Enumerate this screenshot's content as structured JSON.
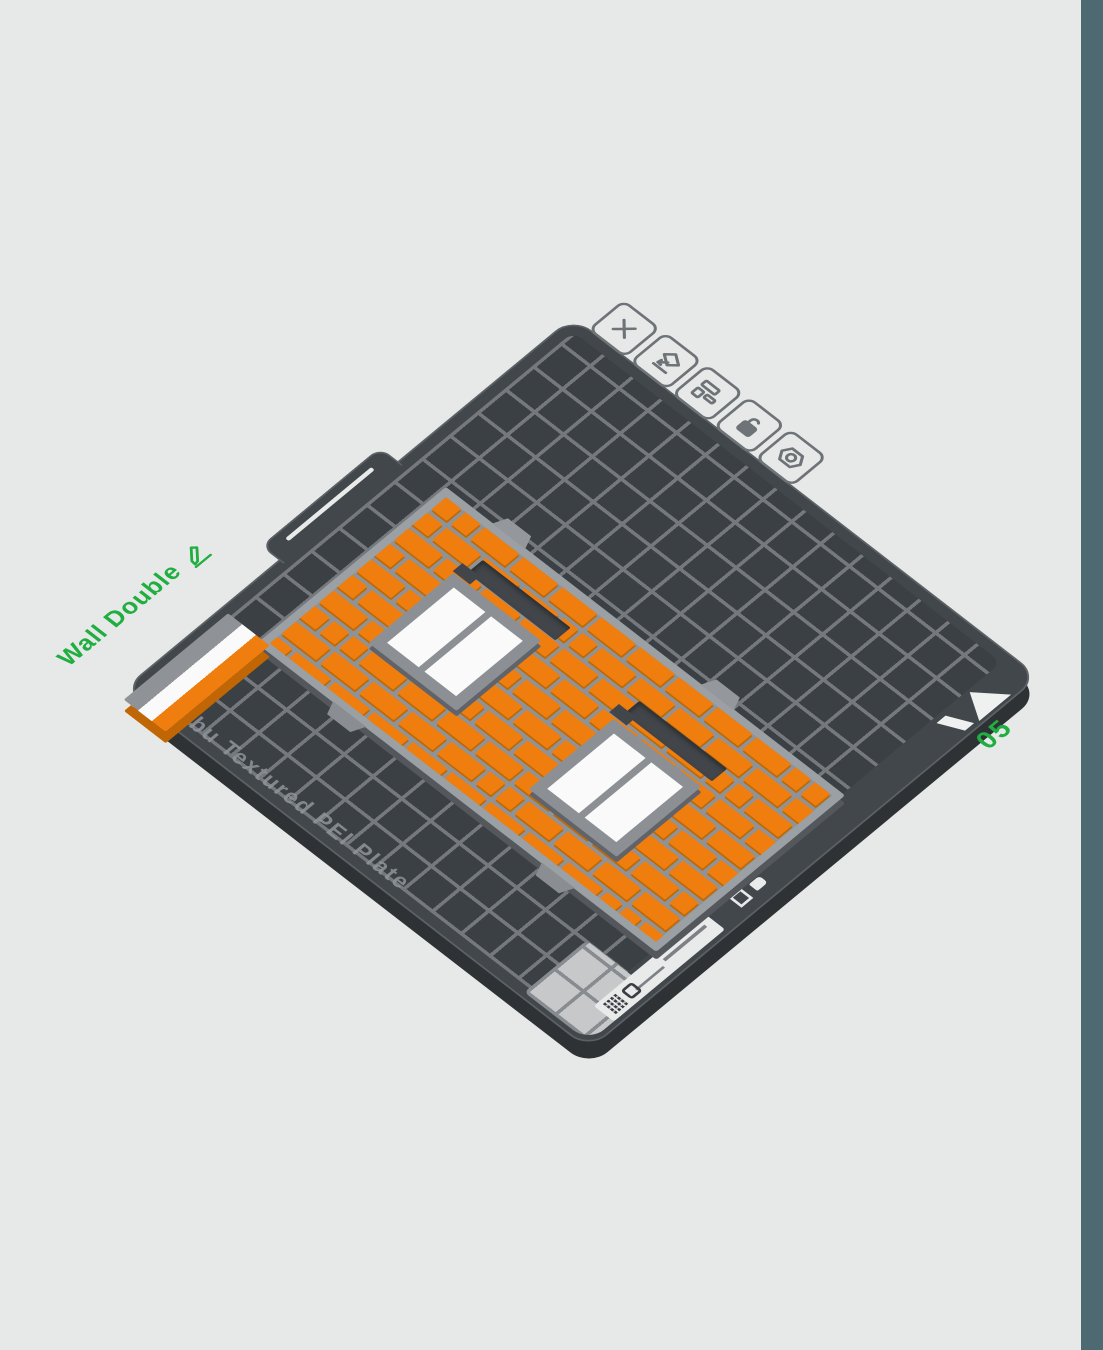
{
  "viewport": {
    "background_color": "#e7e8e8",
    "right_strip_color": "#4d6a73"
  },
  "plate": {
    "name_label": "Wall Double",
    "number": "05",
    "brand_text": "Bambu Textured PEI Plate",
    "accent_green": "#1fae3f",
    "surface_color": "#3b4044",
    "grid_line_color": "#75797d",
    "toolbar_icons": [
      {
        "name": "delete-plate-icon"
      },
      {
        "name": "orient-plate-icon"
      },
      {
        "name": "arrange-plate-icon"
      },
      {
        "name": "lock-plate-icon"
      },
      {
        "name": "plate-settings-icon"
      }
    ],
    "rim_marks": [
      "corner-arrow-mark",
      "hand-icon",
      "square-icon",
      "qr-code-icon",
      "logo-icon"
    ]
  },
  "model": {
    "name": "Wall Double",
    "brick_color": "#ef7e0e",
    "mortar_color": "#8f9397",
    "window_pane_color": "#fafafa",
    "window_frame_color": "#8c9094",
    "swatch_colors": [
      "#8f9397",
      "#fafafa",
      "#ef7e0e"
    ],
    "windows": 2,
    "slots": 2
  }
}
